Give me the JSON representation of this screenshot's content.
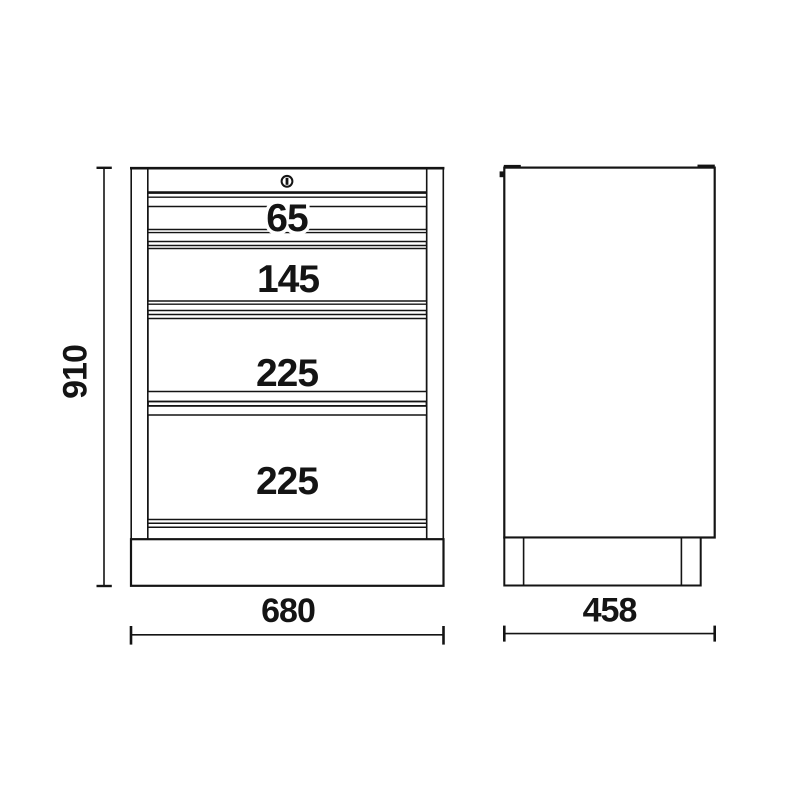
{
  "colors": {
    "line": "#141414",
    "background": "#ffffff"
  },
  "front_view": {
    "height_dim": "910",
    "width_dim": "680",
    "drawer_labels": [
      "65",
      "145",
      "225",
      "225"
    ],
    "lock_icon": "keyhole-icon"
  },
  "side_view": {
    "depth_dim": "458"
  }
}
